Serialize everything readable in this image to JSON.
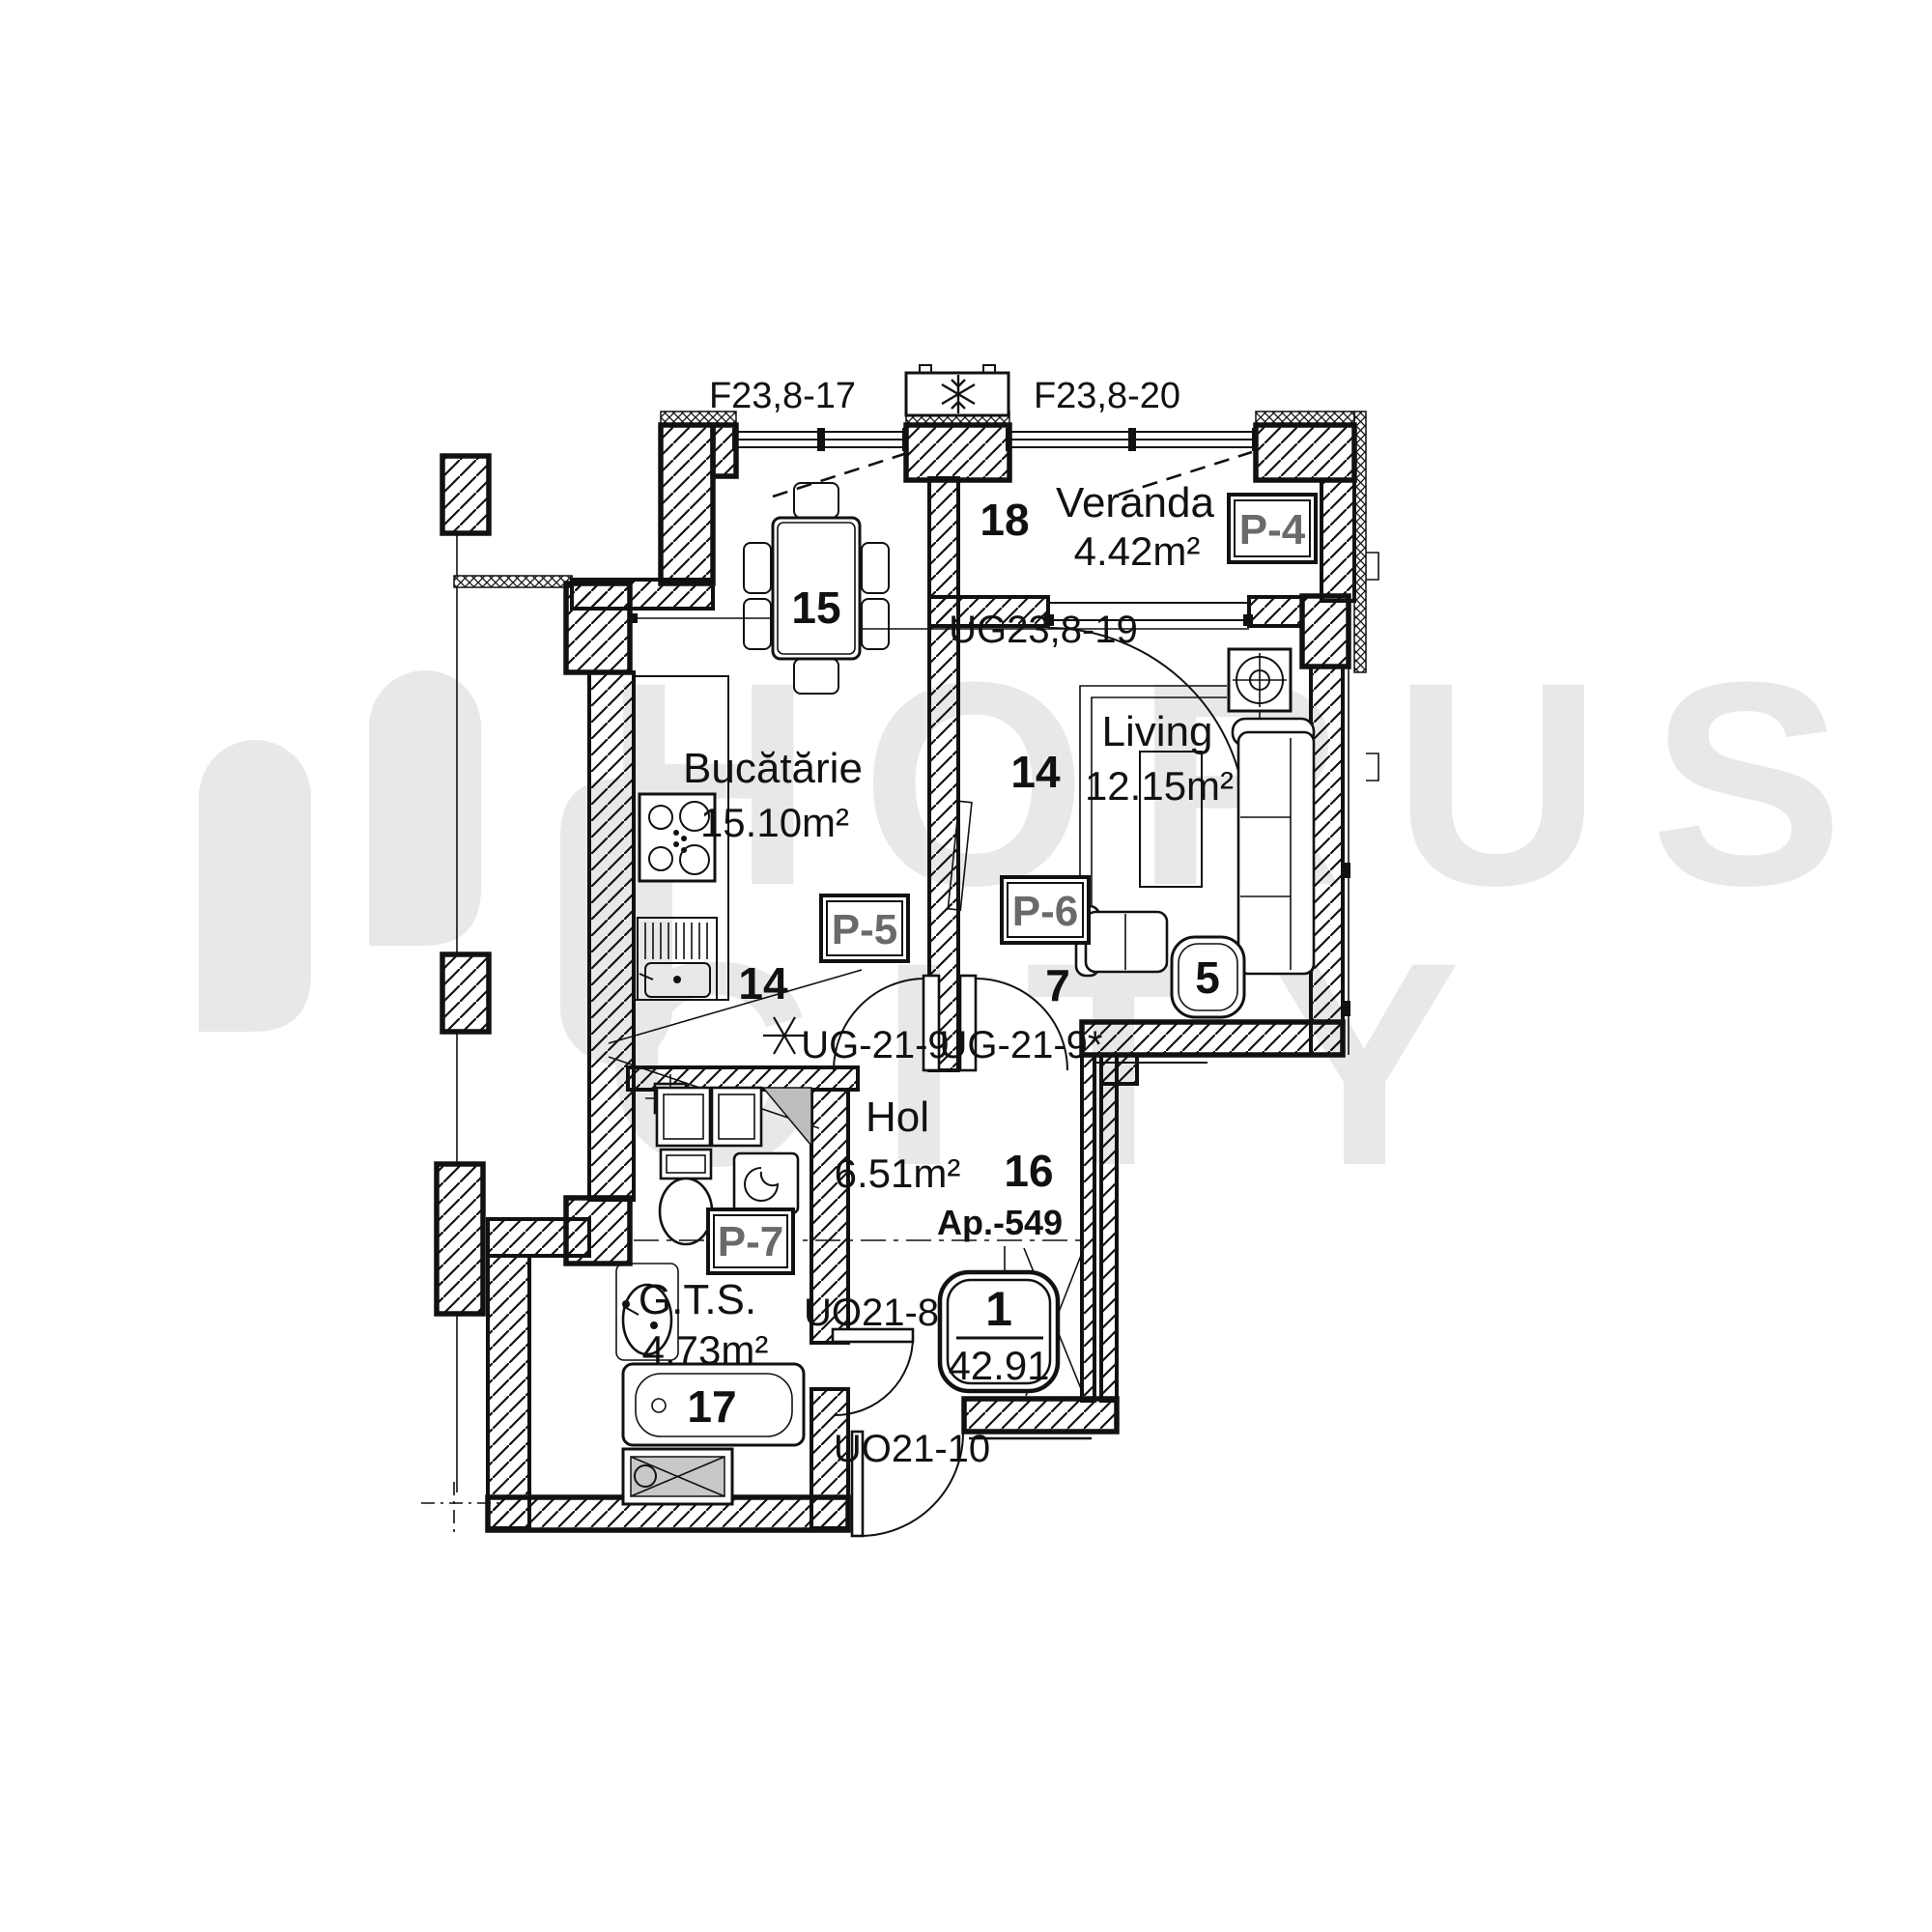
{
  "watermark": {
    "word1": "HORUS",
    "word2": "CITY"
  },
  "apartment": {
    "code": "Ap.-549",
    "number": "1",
    "total_area": "42.91"
  },
  "rooms": {
    "kitchen": {
      "name": "Bucătărie",
      "area": "15.10m²",
      "table_no": "15",
      "zone_no": "14"
    },
    "veranda": {
      "name": "Veranda",
      "area": "4.42m²",
      "zone_no": "18"
    },
    "living": {
      "name": "Living",
      "area": "12.15m²",
      "zone_no": "14",
      "door_zone_no": "7",
      "table_no": "5"
    },
    "hol": {
      "name": "Hol",
      "area": "6.51m²",
      "zone_no": "16"
    },
    "gts": {
      "name": "G.T.S.",
      "area": "4.73m²",
      "zone_no": "17"
    }
  },
  "windows": {
    "kitchen_window": "F23,8-17",
    "veranda_window": "F23,8-20"
  },
  "doors": {
    "veranda_living": "UG23,8-19",
    "hol_kitchen": "UG-21-9",
    "hol_living": "UG-21-9*",
    "gts_door": "UO21-8",
    "entrance_door": "UO21-10"
  },
  "panels": {
    "p4": "P-4",
    "p5": "P-5",
    "p6": "P-6",
    "p7": "P-7"
  },
  "colors": {
    "line": "#111111",
    "panel_text": "#6a6a6a",
    "watermark": "#e8e8e8",
    "duct_gray": "#bdbdbd"
  }
}
